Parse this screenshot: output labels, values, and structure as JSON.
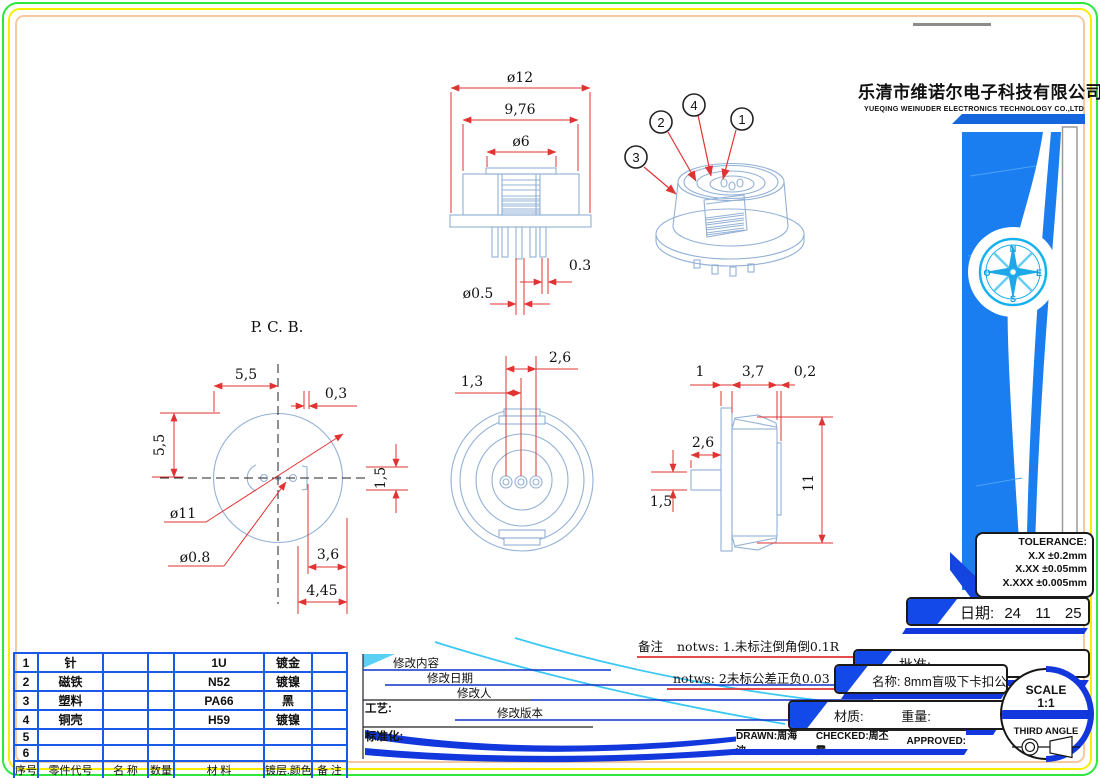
{
  "colors": {
    "part_line": "#93b1d6",
    "dimension_red": "#e23333",
    "accent_blue": "#1238dd",
    "swoosh_blue": "#1a7ef0",
    "cyan": "#19b5f0",
    "table_blue": "#1a5ae8",
    "border_green": "#2fe83e",
    "border_yellow": "#f6ee00",
    "border_peach": "#f7c9a0"
  },
  "company": {
    "name_cn": "乐清市维诺尔电子科技有限公司",
    "name_en": "YUEQING WEINUDER ELECTRONICS TECHNOLOGY CO.,LTD"
  },
  "tolerance": {
    "title": "TOLERANCE:",
    "line1": "X.X  ±0.2mm",
    "line2": "X.XX  ±0.05mm",
    "line3": "X.XXX  ±0.005mm"
  },
  "title_block": {
    "date_label": "日期:",
    "date_value": "24 11 25",
    "approve_label": "批准:",
    "name_label": "名称:",
    "name_value": "8mm盲吸下卡扣公",
    "material_label": "材质:",
    "weight_label": "重量:",
    "drawn": "DRAWN:周海波",
    "checked": "CHECKED:周丕霞",
    "approved": "APPROVED:",
    "scale_label": "SCALE",
    "scale_value": "1:1",
    "projection_label": "THIRD ANGLE"
  },
  "notes": {
    "label": "备注",
    "note1": "notws: 1.未标注倒角倒0.1R",
    "note2": "notws: 2未标公差正负0.03"
  },
  "revision": {
    "content": "修改内容",
    "date": "修改日期",
    "person": "修改人",
    "version": "修改版本",
    "process": "工艺:",
    "standard": "标准化:"
  },
  "bom": {
    "headers": [
      "序号",
      "零件代号",
      "名 称",
      "数量",
      "材 料",
      "镀层.颜色",
      "备 注"
    ],
    "rows": [
      [
        "1",
        "针",
        "",
        "",
        "1U",
        "镀金",
        ""
      ],
      [
        "2",
        "磁铁",
        "",
        "",
        "N52",
        "镀镍",
        ""
      ],
      [
        "3",
        "塑料",
        "",
        "",
        "PA66",
        "黑",
        ""
      ],
      [
        "4",
        "铜壳",
        "",
        "",
        "H59",
        "镀镍",
        ""
      ],
      [
        "5",
        "",
        "",
        "",
        "",
        "",
        ""
      ],
      [
        "6",
        "",
        "",
        "",
        "",
        "",
        ""
      ]
    ]
  },
  "views": {
    "front": {
      "dims": {
        "outer": "ø12",
        "body": "9,76",
        "cap": "ø6",
        "pin_gap": "0.3",
        "pin_dia": "ø0.5"
      }
    },
    "iso": {
      "balloons": [
        "1",
        "2",
        "3",
        "4"
      ]
    },
    "pcb": {
      "label": "P. C. B.",
      "dims": {
        "offset_x": "5,5",
        "slot_w": "0,3",
        "offset_y": "5,5",
        "slot_h": "1,5",
        "board_dia": "ø11",
        "hole_dia": "ø0.8",
        "pitch1": "3,6",
        "pitch2": "4,45"
      }
    },
    "bottom": {
      "dims": {
        "pitch_outer": "2,6",
        "pitch_inner": "1,3"
      }
    },
    "side": {
      "dims": {
        "flange": "1",
        "body": "3,7",
        "step": "0,2",
        "stem": "2,6",
        "stem_h": "1,5",
        "height": "11"
      }
    }
  },
  "compass": {
    "n": "N",
    "e": "E",
    "s": "S",
    "w": "O"
  }
}
